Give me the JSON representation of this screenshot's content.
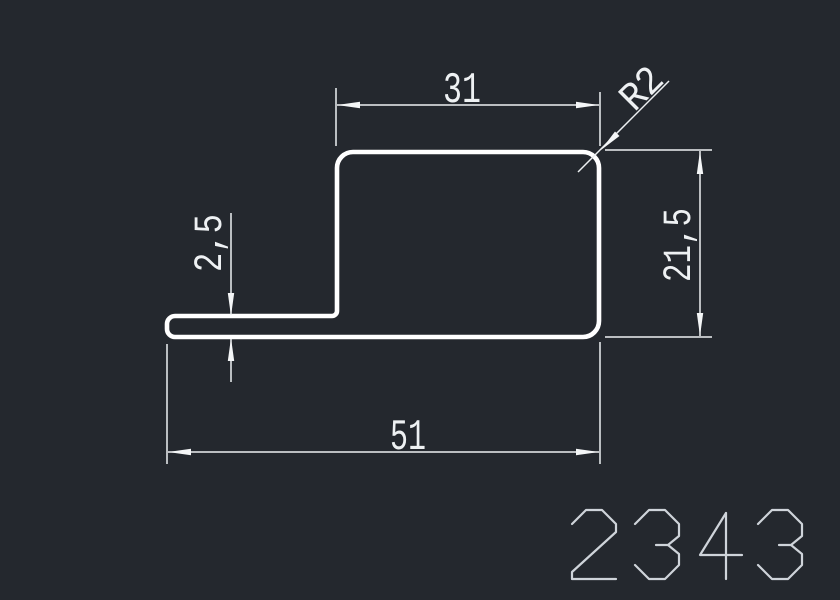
{
  "window": {
    "background": "#24282e"
  },
  "drawing": {
    "type": "profile-cross-section",
    "part_number": "2343",
    "dimensions": {
      "top_width": {
        "label": "31",
        "value": 31
      },
      "corner_radius": {
        "label": "R2",
        "value": 2
      },
      "flange_thickness": {
        "label": "2,5",
        "value": 2.5
      },
      "right_height": {
        "label": "21,5",
        "value": 21.5
      },
      "overall_width": {
        "label": "51",
        "value": 51
      }
    },
    "colors": {
      "background": "#24282e",
      "outline": "#ffffff",
      "dimension_lines": "#edf0f2",
      "dimension_text": "#eef1f3",
      "part_number": "#cfd4da"
    }
  }
}
